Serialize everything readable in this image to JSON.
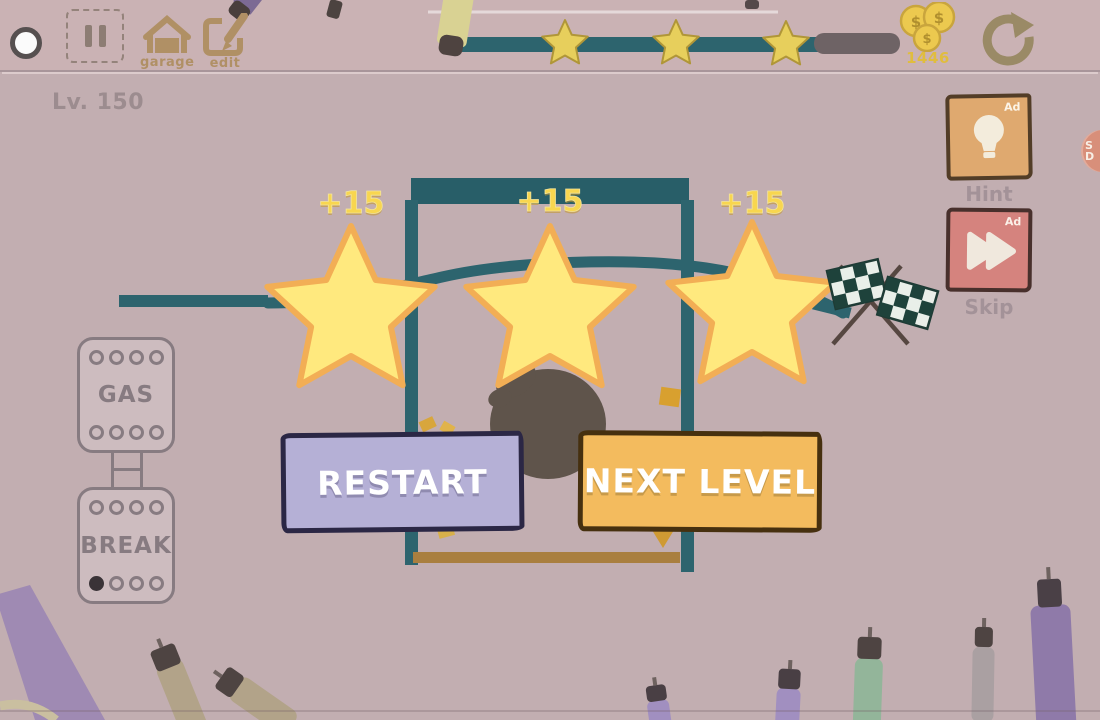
{
  "hud": {
    "level": "Lv. 150",
    "garage": "garage",
    "edit": "edit",
    "coins": "1446",
    "coin_symbol": "$",
    "progress_stars": 3
  },
  "rewards": {
    "values": [
      "+15",
      "+15",
      "+15"
    ]
  },
  "dialog": {
    "restart": "RESTART",
    "next_level": "NEXT LEVEL"
  },
  "side": {
    "hint": {
      "label": "Hint",
      "ad": "Ad"
    },
    "skip": {
      "label": "Skip",
      "ad": "Ad"
    },
    "badge": [
      "S",
      "D"
    ]
  },
  "controls": {
    "gas": "GAS",
    "break": "BREAK"
  },
  "colors": {
    "bg": "#c2aeb1",
    "topbar": "#cab2b4",
    "teal": "#2d646e",
    "platform": "#285e68",
    "star-fill": "#ffe97e",
    "star-stroke": "#f2ae55",
    "small-star-fill": "#e7cf5c",
    "small-star-stroke": "#b09638",
    "reward": "#f8d64f",
    "restart-bg": "#b5b0d6",
    "restart-border": "#2b2745",
    "next-bg": "#f3bb5e",
    "next-border": "#46300f",
    "hint-bg": "#dfa96f",
    "hint-border": "#523d27",
    "skip-bg": "#d5837e",
    "skip-border": "#48302c",
    "floor": "#a97f3f",
    "pedal": "#877b81",
    "blob": "#5f544b",
    "icon-tan": "#b09065",
    "hud-text": "#9c8c8f",
    "coin-text": "#e0bd3e",
    "label-gray": "#a39298"
  }
}
